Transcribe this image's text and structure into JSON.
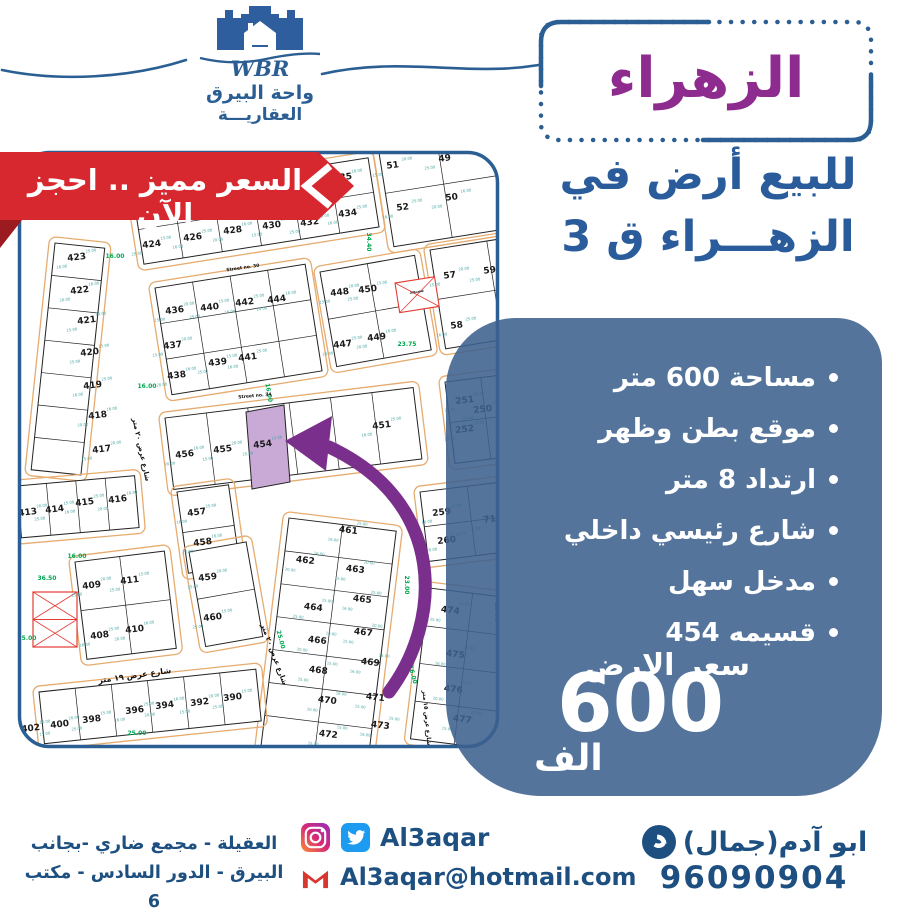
{
  "colors": {
    "accent_blue": "#2b5f93",
    "deep_blue": "#1d4f80",
    "panel_blue": "#3c628e",
    "purple": "#8e2b8e",
    "red": "#d7282f",
    "dark_red": "#9c1b20"
  },
  "brand": {
    "wbr": "WBR",
    "line1": "واحة البيرق",
    "line2": "العقاريـــة"
  },
  "ribbon": {
    "text": "السعر مميز .. احجز الآن"
  },
  "title": {
    "text": "الزهراء"
  },
  "subtitle": {
    "line1": "للبيع أرض في",
    "line2": "الزهـــراء ق 3"
  },
  "features": {
    "items": [
      "مساحة 600 متر",
      "موقع بطن وظهر",
      "ارتداد 8 متر",
      "شارع رئيسي داخلي",
      "مدخل سهل",
      "قسيمه 454"
    ],
    "price_label": "سعر الارض",
    "price_value": "600",
    "price_unit": "الف"
  },
  "footer": {
    "address_line1": "العقيلة - مجمع ضاري -بجانب",
    "address_line2": "البيرق - الدور السادس - مكتب 6",
    "social_handle": "Al3aqar",
    "email": "Al3aqar@hotmail.com",
    "contact_name": "ابو آدم(جمال)",
    "phone": "96090904"
  },
  "map": {
    "colors": {
      "frame": "#2b5f93",
      "street": "#e6ab6e",
      "green": "#00a651",
      "dim": "#45a5a0",
      "plot_line": "#222222",
      "highlight_fill": "#c9a9d6",
      "arrow": "#7b2f8d",
      "red": "#e23b34"
    },
    "blocks": [
      {
        "x": 38,
        "y": 93,
        "w": 50,
        "h": 228,
        "a": 6,
        "c": 1,
        "r": 7
      },
      {
        "x": 116,
        "y": 45,
        "w": 238,
        "h": 70,
        "a": -9,
        "c": 6,
        "r": 2
      },
      {
        "x": 360,
        "y": -10,
        "w": 118,
        "h": 108,
        "a": -9,
        "c": 2,
        "r": 2
      },
      {
        "x": 138,
        "y": 138,
        "w": 152,
        "h": 108,
        "a": -9,
        "c": 4,
        "r": 3
      },
      {
        "x": 303,
        "y": 122,
        "w": 96,
        "h": 96,
        "a": -10,
        "c": 2,
        "r": 2
      },
      {
        "x": 413,
        "y": 100,
        "w": 115,
        "h": 100,
        "a": -9,
        "c": 2,
        "r": 2
      },
      {
        "x": 148,
        "y": 268,
        "w": 250,
        "h": 72,
        "a": -7,
        "c": 6,
        "r": 1
      },
      {
        "x": 428,
        "y": 232,
        "w": 72,
        "h": 82,
        "a": -7,
        "c": 2,
        "r": 2
      },
      {
        "x": 0,
        "y": 336,
        "w": 118,
        "h": 52,
        "a": -5,
        "c": 4,
        "r": 1
      },
      {
        "x": 160,
        "y": 342,
        "w": 52,
        "h": 82,
        "a": -8,
        "c": 1,
        "r": 2
      },
      {
        "x": 58,
        "y": 412,
        "w": 90,
        "h": 98,
        "a": -7,
        "c": 2,
        "r": 2
      },
      {
        "x": 172,
        "y": 402,
        "w": 58,
        "h": 96,
        "a": -10,
        "c": 1,
        "r": 2
      },
      {
        "x": 272,
        "y": 368,
        "w": 108,
        "h": 232,
        "a": 7,
        "c": 2,
        "r": 7
      },
      {
        "x": 22,
        "y": 542,
        "w": 218,
        "h": 52,
        "a": -6,
        "c": 6,
        "r": 1
      },
      {
        "x": 403,
        "y": 342,
        "w": 95,
        "h": 70,
        "a": -7,
        "c": 2,
        "r": 2
      },
      {
        "x": 412,
        "y": 438,
        "w": 88,
        "h": 152,
        "a": 7,
        "c": 2,
        "r": 4
      }
    ],
    "plots": [
      {
        "n": "423",
        "x": 60,
        "y": 110
      },
      {
        "n": "422",
        "x": 63,
        "y": 143
      },
      {
        "n": "421",
        "x": 70,
        "y": 173
      },
      {
        "n": "420",
        "x": 73,
        "y": 205
      },
      {
        "n": "419",
        "x": 76,
        "y": 238
      },
      {
        "n": "418",
        "x": 81,
        "y": 268
      },
      {
        "n": "417",
        "x": 85,
        "y": 302
      },
      {
        "n": "424",
        "x": 135,
        "y": 97
      },
      {
        "n": "426",
        "x": 176,
        "y": 90
      },
      {
        "n": "428",
        "x": 216,
        "y": 83
      },
      {
        "n": "430",
        "x": 255,
        "y": 78
      },
      {
        "n": "432",
        "x": 293,
        "y": 75
      },
      {
        "n": "434",
        "x": 331,
        "y": 66
      },
      {
        "n": "435",
        "x": 326,
        "y": 30
      },
      {
        "n": "51",
        "x": 376,
        "y": 18
      },
      {
        "n": "49",
        "x": 428,
        "y": 11
      },
      {
        "n": "52",
        "x": 386,
        "y": 60
      },
      {
        "n": "50",
        "x": 435,
        "y": 50
      },
      {
        "n": "436",
        "x": 158,
        "y": 163
      },
      {
        "n": "440",
        "x": 193,
        "y": 160
      },
      {
        "n": "442",
        "x": 228,
        "y": 155
      },
      {
        "n": "444",
        "x": 260,
        "y": 152
      },
      {
        "n": "437",
        "x": 156,
        "y": 198
      },
      {
        "n": "439",
        "x": 201,
        "y": 215
      },
      {
        "n": "441",
        "x": 231,
        "y": 210
      },
      {
        "n": "438",
        "x": 160,
        "y": 228
      },
      {
        "n": "448",
        "x": 323,
        "y": 145
      },
      {
        "n": "450",
        "x": 351,
        "y": 142
      },
      {
        "n": "447",
        "x": 326,
        "y": 197
      },
      {
        "n": "449",
        "x": 360,
        "y": 190
      },
      {
        "n": "57",
        "x": 433,
        "y": 128
      },
      {
        "n": "59",
        "x": 473,
        "y": 123
      },
      {
        "n": "58",
        "x": 440,
        "y": 178
      },
      {
        "n": "456",
        "x": 168,
        "y": 307
      },
      {
        "n": "455",
        "x": 206,
        "y": 302
      },
      {
        "n": "454",
        "x": 246,
        "y": 297
      },
      {
        "n": "451",
        "x": 365,
        "y": 278
      },
      {
        "n": "251",
        "x": 448,
        "y": 253
      },
      {
        "n": "252",
        "x": 448,
        "y": 282
      },
      {
        "n": "250",
        "x": 466,
        "y": 262
      },
      {
        "n": "457",
        "x": 180,
        "y": 365
      },
      {
        "n": "458",
        "x": 186,
        "y": 395
      },
      {
        "n": "413",
        "x": 11,
        "y": 365
      },
      {
        "n": "414",
        "x": 38,
        "y": 362
      },
      {
        "n": "415",
        "x": 68,
        "y": 355
      },
      {
        "n": "416",
        "x": 101,
        "y": 352
      },
      {
        "n": "409",
        "x": 75,
        "y": 438
      },
      {
        "n": "411",
        "x": 113,
        "y": 433
      },
      {
        "n": "408",
        "x": 83,
        "y": 488
      },
      {
        "n": "410",
        "x": 118,
        "y": 482
      },
      {
        "n": "459",
        "x": 191,
        "y": 430
      },
      {
        "n": "460",
        "x": 196,
        "y": 470
      },
      {
        "n": "461",
        "x": 331,
        "y": 383,
        "t": 7
      },
      {
        "n": "462",
        "x": 288,
        "y": 413,
        "t": 7
      },
      {
        "n": "463",
        "x": 338,
        "y": 422,
        "t": 7
      },
      {
        "n": "464",
        "x": 296,
        "y": 460,
        "t": 7
      },
      {
        "n": "465",
        "x": 345,
        "y": 452,
        "t": 7
      },
      {
        "n": "466",
        "x": 300,
        "y": 493,
        "t": 7
      },
      {
        "n": "467",
        "x": 346,
        "y": 485,
        "t": 7
      },
      {
        "n": "468",
        "x": 301,
        "y": 523,
        "t": 7
      },
      {
        "n": "469",
        "x": 353,
        "y": 515,
        "t": 7
      },
      {
        "n": "470",
        "x": 310,
        "y": 553,
        "t": 7
      },
      {
        "n": "471",
        "x": 358,
        "y": 550,
        "t": 7
      },
      {
        "n": "472",
        "x": 311,
        "y": 587,
        "t": 7
      },
      {
        "n": "473",
        "x": 363,
        "y": 578,
        "t": 7
      },
      {
        "n": "402",
        "x": 14,
        "y": 581
      },
      {
        "n": "400",
        "x": 43,
        "y": 577
      },
      {
        "n": "398",
        "x": 75,
        "y": 572
      },
      {
        "n": "396",
        "x": 118,
        "y": 563
      },
      {
        "n": "394",
        "x": 148,
        "y": 558
      },
      {
        "n": "392",
        "x": 183,
        "y": 555
      },
      {
        "n": "390",
        "x": 216,
        "y": 550
      },
      {
        "n": "259",
        "x": 425,
        "y": 365
      },
      {
        "n": "260",
        "x": 430,
        "y": 393
      },
      {
        "n": "71",
        "x": 473,
        "y": 372
      },
      {
        "n": "474",
        "x": 433,
        "y": 463,
        "t": 7
      },
      {
        "n": "475",
        "x": 438,
        "y": 507,
        "t": 7
      },
      {
        "n": "476",
        "x": 436,
        "y": 542,
        "t": 7
      },
      {
        "n": "477",
        "x": 445,
        "y": 572,
        "t": 7
      }
    ],
    "dim_values": [
      "25.00",
      "16.00",
      "20.00",
      "15.00"
    ],
    "green_labels": [
      {
        "t": "16.00",
        "x": 98,
        "y": 108,
        "r": 0
      },
      {
        "t": "34.40",
        "x": 350,
        "y": 92,
        "r": 90
      },
      {
        "t": "16.00",
        "x": 250,
        "y": 243,
        "r": 80
      },
      {
        "t": "23.75",
        "x": 390,
        "y": 196,
        "r": 0
      },
      {
        "t": "23.00",
        "x": 388,
        "y": 435,
        "r": 90
      },
      {
        "t": "16.00",
        "x": 394,
        "y": 525,
        "r": 75
      },
      {
        "t": "36.50",
        "x": 30,
        "y": 430,
        "r": 0
      },
      {
        "t": "25.00",
        "x": 10,
        "y": 490,
        "r": 0
      },
      {
        "t": "16.00",
        "x": 60,
        "y": 408,
        "r": 0
      },
      {
        "t": "25.00",
        "x": 262,
        "y": 490,
        "r": 75
      },
      {
        "t": "16.00",
        "x": 130,
        "y": 238,
        "r": 0
      },
      {
        "t": "23.00",
        "x": 478,
        "y": 462,
        "r": 90
      },
      {
        "t": "25.00",
        "x": 120,
        "y": 585,
        "r": 0
      }
    ],
    "street_labels": [
      {
        "t": "Street no. 30",
        "x": 226,
        "y": 119,
        "r": -8,
        "s": 4.5
      },
      {
        "t": "Street no. 34",
        "x": 238,
        "y": 247,
        "r": -5,
        "s": 4.5
      },
      {
        "t": "شارع عرض ٢٠ متر",
        "x": 122,
        "y": 300,
        "r": 78,
        "s": 7
      },
      {
        "t": "شارع عرض ١٩ متر",
        "x": 118,
        "y": 528,
        "r": -8,
        "s": 8
      },
      {
        "t": "شارع عرض ٢٠ متر",
        "x": 255,
        "y": 505,
        "r": 70,
        "s": 7
      },
      {
        "t": "شارع عرض ١٥ متر",
        "x": 408,
        "y": 568,
        "r": 85,
        "s": 6
      }
    ],
    "mosque": {
      "x": 378,
      "y": 133,
      "w": 40,
      "h": 30,
      "label": "مسجد"
    },
    "red_block": {
      "x": 16,
      "y": 442,
      "w": 44,
      "h": 55
    },
    "highlight": {
      "points": "229,262 267,255 273,332 235,339"
    },
    "arrow": {
      "path": "M372,542 C426,470 430,352 312,297",
      "head": "268,291 315,266 309,321"
    }
  }
}
